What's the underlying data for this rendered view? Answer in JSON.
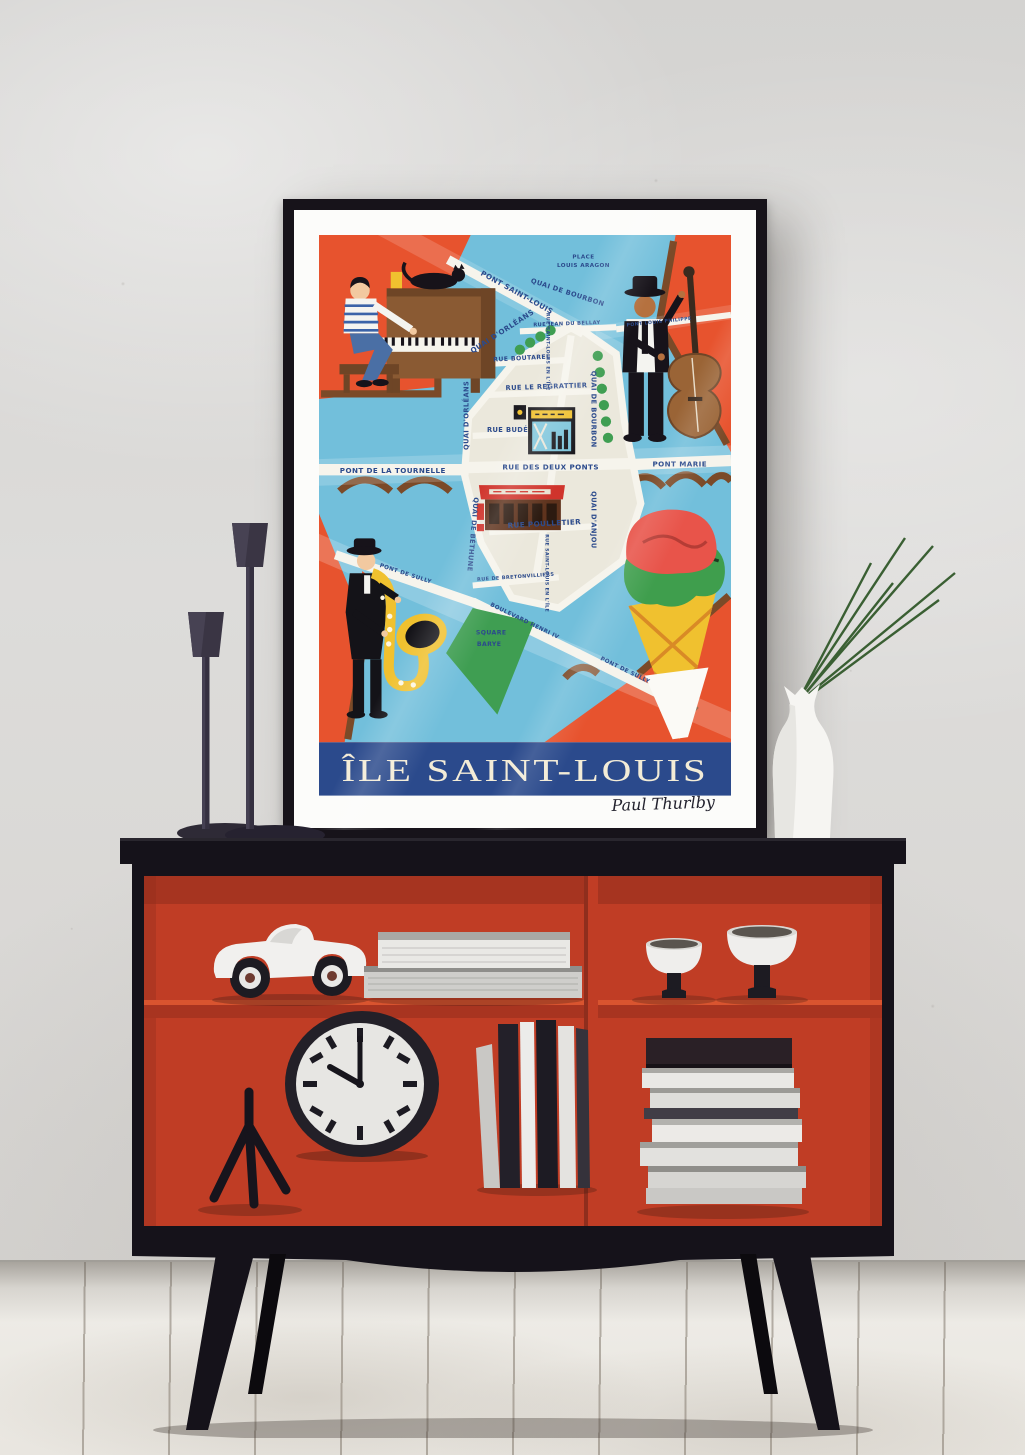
{
  "poster": {
    "title": "ÎLE SAINT-LOUIS",
    "signature": "Paul Thurlby",
    "labels": {
      "pont_saint_louis": "PONT SAINT-LOUIS",
      "place_louis_aragon_1": "PLACE",
      "place_louis_aragon_2": "LOUIS ARAGON",
      "quai_de_bourbon": "QUAI DE BOURBON",
      "rue_jean_du_bellay": "RUE JEAN DU BELLAY",
      "pont_louis_philippe": "PONT LOUIS PHILIPPE",
      "quai_dorleans": "QUAI D'ORLÉANS",
      "rue_boutarel": "RUE BOUTAREL",
      "rue_saint_louis_en_lile": "RUE SAINT-LOUIS EN L'ÎLE",
      "rue_le_regrattier": "RUE LE REGRATTIER",
      "rue_bude": "RUE BUDÉ",
      "pont_de_la_tournelle": "PONT DE LA TOURNELLE",
      "rue_des_deux_ponts": "RUE DES DEUX PONTS",
      "pont_marie": "PONT MARIE",
      "quai_danjou": "QUAI D'ANJOU",
      "quai_de_bethune": "QUAI DE BÉTHUNE",
      "rue_poulletier": "RUE POULLETIER",
      "rue_de_bretonvilliers": "RUE DE BRETONVILLIERS",
      "pont_de_sully_west": "PONT DE SULLY",
      "pont_de_sully_east": "PONT DE SULLY",
      "boulevard_henri_iv": "BOULEVARD HENRI IV",
      "square_barye_1": "SQUARE",
      "square_barye_2": "BARYE"
    },
    "illustrations": [
      "pianist-with-black-cat-on-upright-piano",
      "double-bass-player",
      "saxophonist",
      "ice-cream-cone-two-scoops",
      "jazz-club-storefront",
      "cafe-with-red-awning",
      "square-barye-park",
      "bridge-arches",
      "riverside-trees"
    ],
    "colors": {
      "background": "#e7532e",
      "river": "#72bfdb",
      "island": "#ebe8dc",
      "title_band": "#2b4a8c",
      "title_text": "#f3ecd7",
      "label_text": "#2b4a8c",
      "park_green": "#3f9e52",
      "bridge_brown": "#7b4a28"
    }
  },
  "furniture": {
    "sideboard": {
      "frame_color": "#15121a",
      "interior_color": "#c03d25",
      "top_shelf_items": [
        "toy-race-car",
        "stack-of-two-books",
        "two-pedestal-bowls"
      ],
      "bottom_shelf_items": [
        "tripod-stand",
        "round-clock",
        "row-of-upright-books",
        "stack-of-books"
      ]
    },
    "clock_time": "10:00",
    "decor_on_top": [
      "two-dark-candlesticks",
      "framed-poster",
      "white-vase-with-green-grass-stems"
    ]
  }
}
